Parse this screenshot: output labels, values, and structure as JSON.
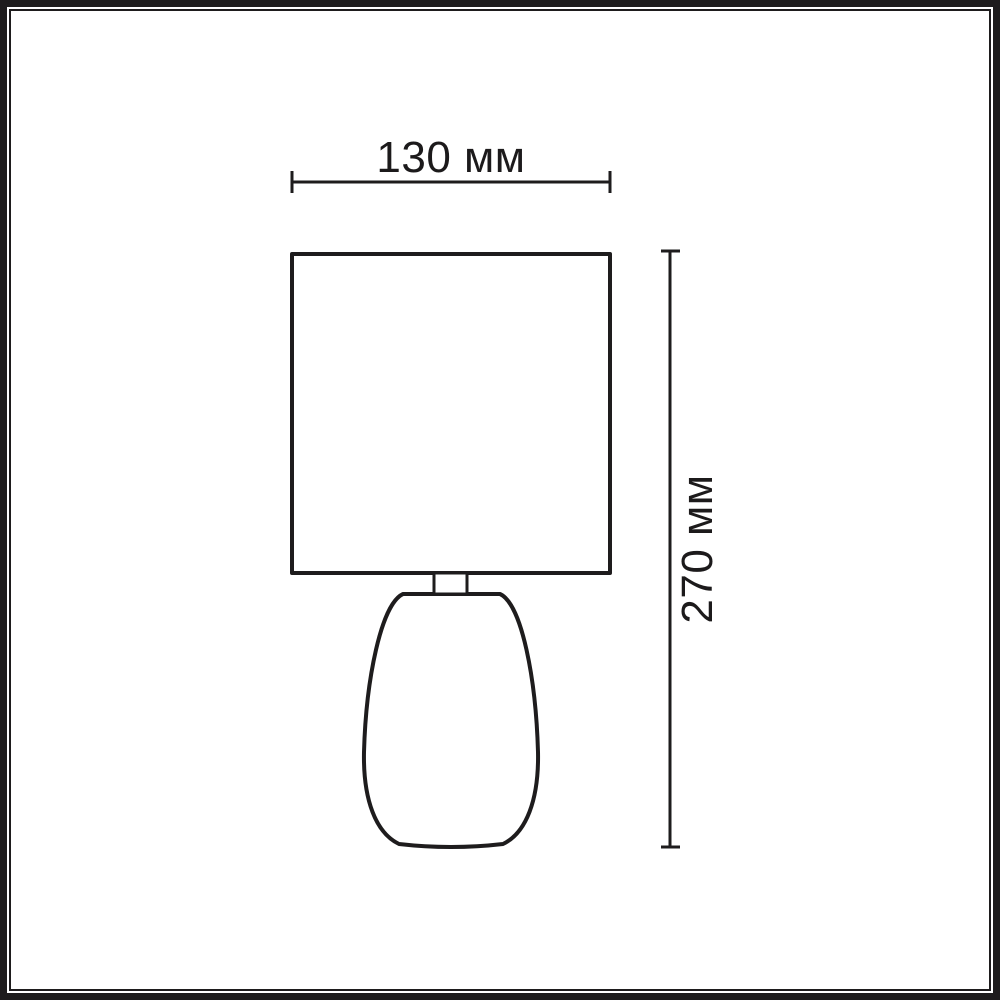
{
  "diagram": {
    "type": "product-dimension-drawing",
    "subject": "table-lamp",
    "background_color": "#ffffff",
    "line_color": "#1e1c1d",
    "frame": {
      "style": "double-border",
      "color": "#1e1c1d"
    },
    "dimensions": {
      "width": {
        "label": "130 мм",
        "value_mm": 130,
        "orientation": "horizontal",
        "position": "top"
      },
      "height": {
        "label": "270 мм",
        "value_mm": 270,
        "orientation": "vertical",
        "position": "right"
      }
    },
    "parts": [
      "lamp-shade",
      "lamp-neck",
      "lamp-base"
    ]
  }
}
